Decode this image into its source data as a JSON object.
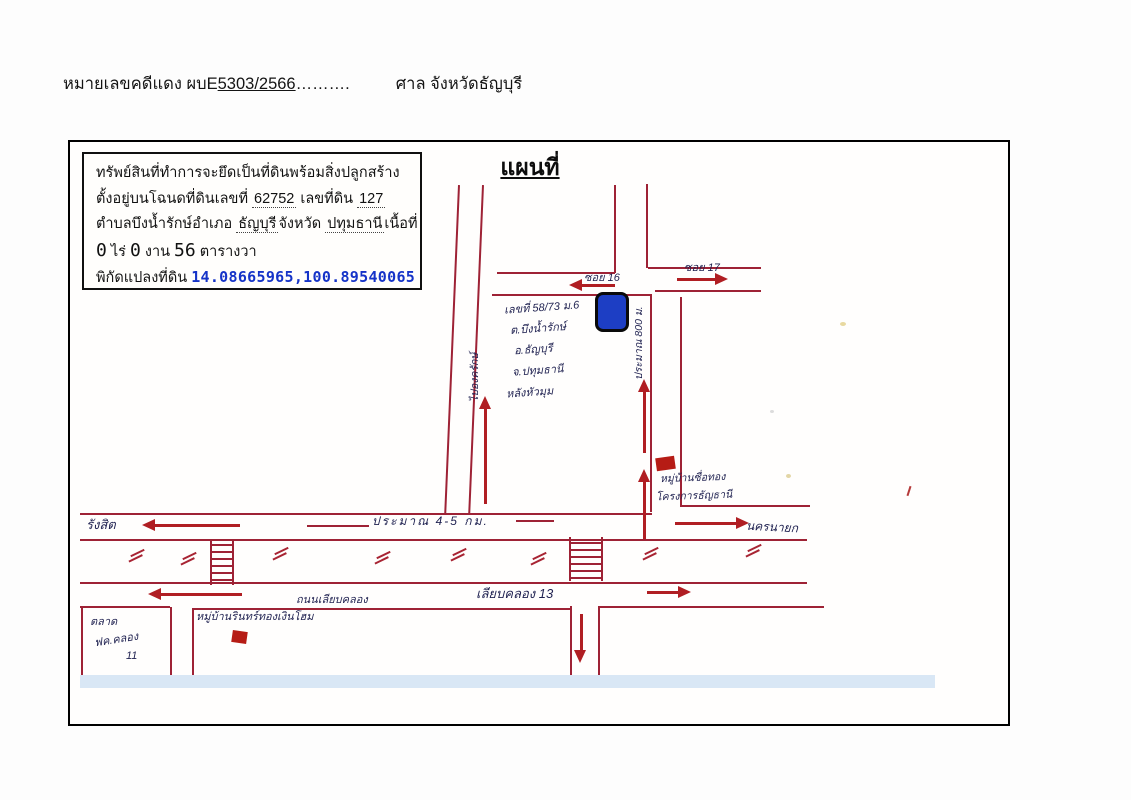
{
  "header": {
    "prefix": "หมายเลขคดีแดง ผบE",
    "case_no": "5303/2566",
    "dots": "……….",
    "court": "ศาล จังหวัดธัญบุรี"
  },
  "info_box": {
    "line1": "ทรัพย์สินที่ทำการจะยึดเป็นที่ดินพร้อมสิ่งปลูกสร้าง",
    "line2": {
      "label1": "ตั้งอยู่บนโฉนดที่ดินเลขที่",
      "deed_no": "62752",
      "label2": "เลขที่ดิน",
      "land_no": "127"
    },
    "line3": {
      "label1": "ตำบลบึงน้ำรักษ์",
      "label2": "อำเภอ",
      "amphoe": "ธัญบุรี",
      "label3": "จังหวัด",
      "province": "ปทุมธานี",
      "label4": "เนื้อที่"
    },
    "area": {
      "rai": "0",
      "rai_label": "ไร่",
      "ngan": "0",
      "ngan_label": "งาน",
      "wa": "56",
      "wa_label": "ตารางวา"
    },
    "coords_label": "พิกัดแปลงที่ดิน",
    "coords": "14.08665965,100.89540065"
  },
  "map": {
    "title": "แผนที่",
    "labels": {
      "soi16": "ซอย 16",
      "soi17": "ซอย 17",
      "to_ongkharak": "ไปองครักษ์",
      "approx_800m": "ประมาณ 800 ม.",
      "address1": "เลขที่ 58/73 ม.6",
      "address2": "ต.บึงน้ำรักษ์",
      "address3": "อ.ธัญบุรี",
      "address4": "จ.ปทุมธานี",
      "address5": "หลังหัวมุม",
      "village1_line1": "หมู่บ้านซื่อทอง",
      "village1_line2": "โครงการธัญธานี",
      "rangsit": "รังสิต",
      "approx_4_5km": "ประมาณ 4-5 กม.",
      "nakhon_nayok": "นครนายก",
      "road_liap_khlong": "ถนนเลียบคลอง",
      "liap_khlong_13": "เลียบคลอง 13",
      "market1": "ตลาด",
      "market2": "ฟค.คลอง",
      "market3": "11",
      "village2": "หมู่บ้านรินทร์ทองเงินโฮม"
    },
    "colors": {
      "road_red": "#9e2235",
      "arrow_red": "#b01e23",
      "ink_blue": "#1f2150",
      "parcel_blue": "#1d3ec4",
      "building_red": "#b61c15",
      "coord_blue": "#1533c8",
      "strip_blue": "#d9e7f5"
    }
  }
}
